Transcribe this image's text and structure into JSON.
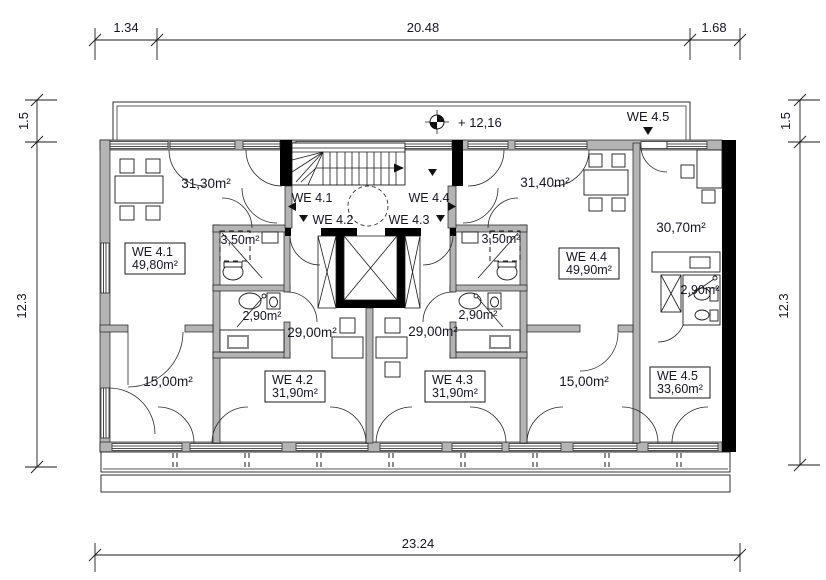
{
  "drawing": {
    "type": "architectural floor plan, attic storey with 5 apartments"
  },
  "dimensions": {
    "top_left": "1.34",
    "top_middle": "20.48",
    "top_right": "1.68",
    "bottom": "23.24",
    "left_top": "1.5",
    "left_side": "12.3",
    "right_top": "1.5",
    "right_side": "12.3"
  },
  "annotations": {
    "level_height": "+ 12,16",
    "entry_label_we45": "WE 4.5"
  },
  "landing": {
    "unit1": "WE 4.1",
    "unit2": "WE 4.2",
    "unit3": "WE 4.3",
    "unit4": "WE 4.4"
  },
  "units": {
    "we41": {
      "id": "WE 4.1",
      "area": "49,80m²"
    },
    "we42": {
      "id": "WE 4.2",
      "area": "31,90m²"
    },
    "we43": {
      "id": "WE 4.3",
      "area": "31,90m²"
    },
    "we44": {
      "id": "WE 4.4",
      "area": "49,90m²"
    },
    "we45": {
      "id": "WE 4.5",
      "area": "33,60m²"
    }
  },
  "rooms": {
    "living_left": "31,30m²",
    "living_right": "31,40m²",
    "living_we45": "30,70m²",
    "bath_left": "3,50m²",
    "bath_right": "3,50m²",
    "shower_we42": "2,90m²",
    "shower_we43": "2,90m²",
    "shower_we45": "2,90m²",
    "studio_we42": "29,00m²",
    "studio_we43": "29,00m²",
    "bedroom_left": "15,00m²",
    "bedroom_right": "15,00m²"
  },
  "colors": {
    "wall_gray": "#b4b4b4",
    "wall_black": "#000000",
    "line": "#1a1a1a",
    "background": "#ffffff"
  }
}
